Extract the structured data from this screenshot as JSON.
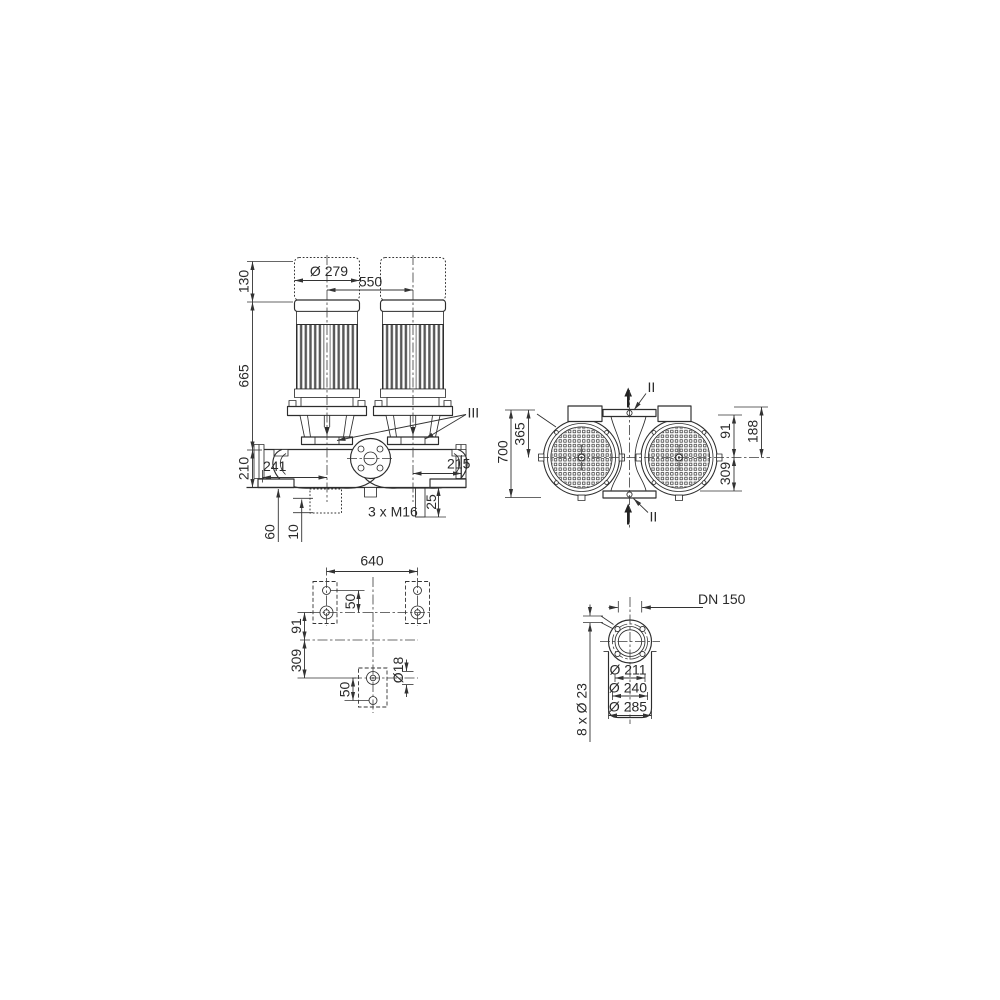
{
  "drawing": {
    "front_view": {
      "dim_height_130": "130",
      "dim_height_665": "665",
      "dim_height_210": "210",
      "dim_motor_diameter": "Ø 279",
      "dim_motor_spacing": "550",
      "dim_left_241": "241",
      "dim_right_215": "215",
      "dim_depth_25": "25",
      "thread_callout": "3 x M16",
      "dim_foot_60": "60",
      "dim_foot_10": "10",
      "section_label": "III"
    },
    "side_view": {
      "dim_total_700": "700",
      "dim_365": "365",
      "dim_91": "91",
      "dim_188": "188",
      "dim_309": "309",
      "section_label_top": "II",
      "section_label_bottom": "II"
    },
    "plan_view": {
      "dim_width_640": "640",
      "dim_50_upper": "50",
      "dim_91": "91",
      "dim_309": "309",
      "dim_50_lower": "50",
      "hole_diameter": "Ø18"
    },
    "flange_view": {
      "nominal_diameter": "DN 150",
      "dim_diameter_211": "Ø 211",
      "dim_diameter_240": "Ø 240",
      "dim_diameter_285": "Ø 285",
      "bolt_hole_callout": "8 x Ø 23"
    }
  }
}
